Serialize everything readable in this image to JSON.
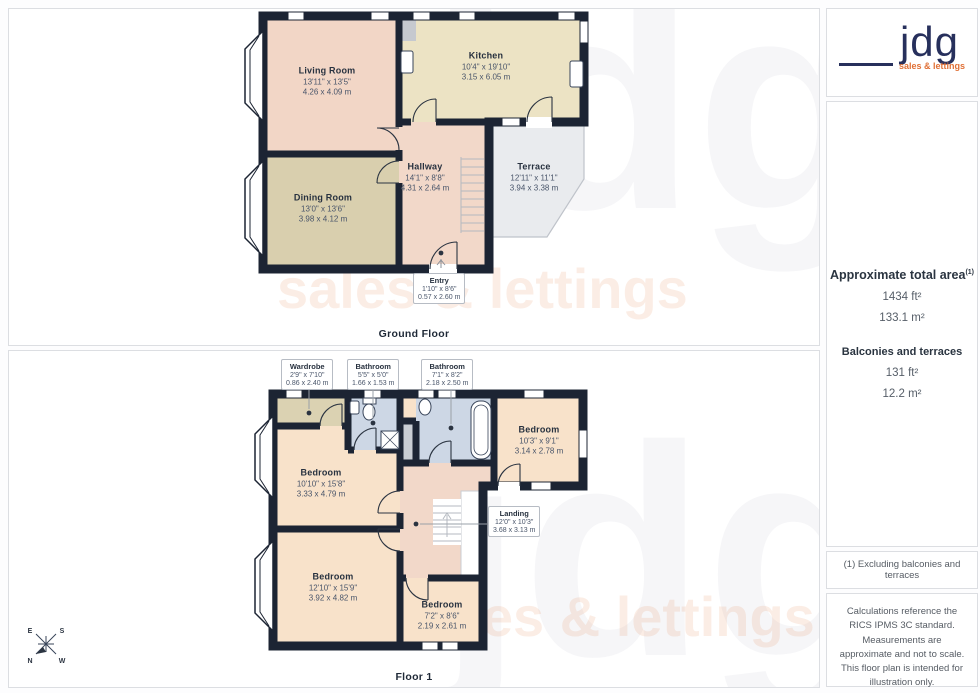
{
  "branding": {
    "logo_text": "jdg",
    "logo_tagline": "sales & lettings",
    "navy": "#27305c",
    "orange": "#e07036"
  },
  "watermark": {
    "text": "jdg",
    "tagline": "sales & lettings"
  },
  "sidebar": {
    "area_heading": "Approximate total area",
    "area_heading_sup": "(1)",
    "total_ft": "1434 ft²",
    "total_m": "133.1 m²",
    "balconies_heading": "Balconies and terraces",
    "balconies_ft": "131 ft²",
    "balconies_m": "12.2 m²",
    "note1": "(1) Excluding balconies and terraces",
    "note2": "Calculations reference the RICS IPMS 3C standard. Measurements are approximate and not to scale. This floor plan is intended for illustration only.",
    "brand_name": "GIRAFFE",
    "brand_number": "360"
  },
  "compass": {
    "n": "N",
    "e": "E",
    "s": "S",
    "w": "W"
  },
  "floors": [
    {
      "label": "Ground Floor",
      "rooms": [
        {
          "name": "Living Room",
          "dims_ft": "13'11\" x 13'5\"",
          "dims_m": "4.26 x 4.09 m"
        },
        {
          "name": "Kitchen",
          "dims_ft": "10'4\" x 19'10\"",
          "dims_m": "3.15 x 6.05 m"
        },
        {
          "name": "Hallway",
          "dims_ft": "14'1\" x 8'8\"",
          "dims_m": "4.31 x 2.64 m"
        },
        {
          "name": "Dining Room",
          "dims_ft": "13'0\" x 13'6\"",
          "dims_m": "3.98 x 4.12 m"
        },
        {
          "name": "Terrace",
          "dims_ft": "12'11\" x 11'1\"",
          "dims_m": "3.94 x 3.38 m"
        },
        {
          "name": "Entry",
          "dims_ft": "1'10\" x 8'6\"",
          "dims_m": "0.57 x 2.60 m"
        }
      ]
    },
    {
      "label": "Floor 1",
      "rooms": [
        {
          "name": "Wardrobe",
          "dims_ft": "2'9\" x 7'10\"",
          "dims_m": "0.86 x 2.40 m"
        },
        {
          "name": "Bathroom",
          "dims_ft": "5'5\" x 5'0\"",
          "dims_m": "1.66 x 1.53 m"
        },
        {
          "name": "Bathroom",
          "dims_ft": "7'1\" x 8'2\"",
          "dims_m": "2.18 x 2.50 m"
        },
        {
          "name": "Bedroom",
          "dims_ft": "10'3\" x 9'1\"",
          "dims_m": "3.14 x 2.78 m"
        },
        {
          "name": "Bedroom",
          "dims_ft": "10'10\" x 15'8\"",
          "dims_m": "3.33 x 4.79 m"
        },
        {
          "name": "Landing",
          "dims_ft": "12'0\" x 10'3\"",
          "dims_m": "3.68 x 3.13 m"
        },
        {
          "name": "Bedroom",
          "dims_ft": "12'10\" x 15'9\"",
          "dims_m": "3.92 x 4.82 m"
        },
        {
          "name": "Bedroom",
          "dims_ft": "7'2\" x 8'6\"",
          "dims_m": "2.19 x 2.61 m"
        }
      ]
    }
  ]
}
